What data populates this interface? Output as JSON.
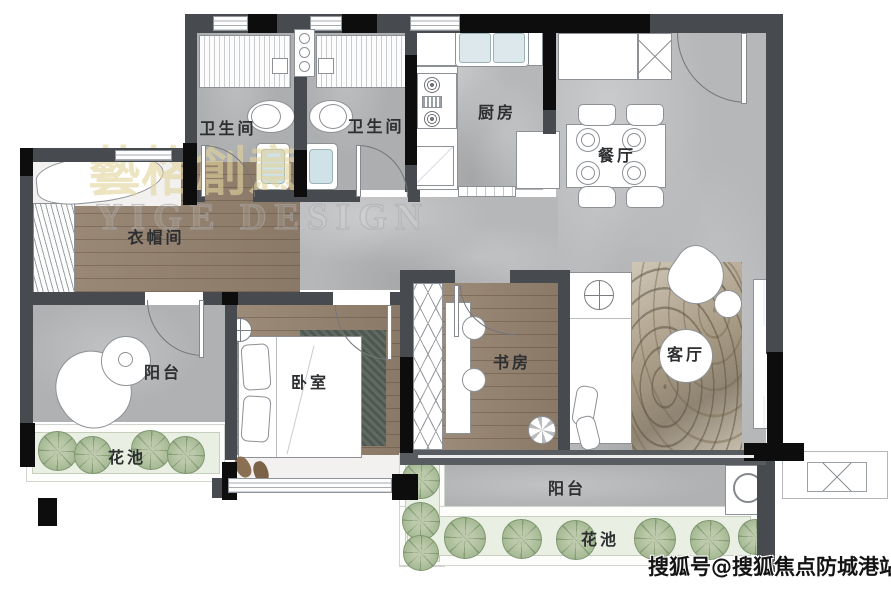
{
  "rooms": {
    "bathroom_left": {
      "label": "卫生间"
    },
    "bathroom_right": {
      "label": "卫生间"
    },
    "kitchen": {
      "label": "厨房"
    },
    "dining": {
      "label": "餐厅"
    },
    "cloakroom": {
      "label": "衣帽间"
    },
    "balcony_left": {
      "label": "阳台"
    },
    "flowerbed_left": {
      "label": "花池"
    },
    "bedroom": {
      "label": "卧室"
    },
    "study": {
      "label": "书房"
    },
    "living": {
      "label": "客厅"
    },
    "balcony_south": {
      "label": "阳台"
    },
    "flowerbed_south": {
      "label": "花池"
    }
  },
  "watermarks": {
    "studio_cn": "藝格創意",
    "studio_en": "YIGE DESIGN",
    "sohu": "搜狐号@搜狐焦点防城港站"
  },
  "palette": {
    "wall": "#474b50",
    "wall_black": "#0d0d0e",
    "marble_floor": "#b6b7b9",
    "wood_floor": "#95826f",
    "balcony_floor": "#b0b1b3",
    "flowerbed_green": "#e9efe2",
    "plant_green": "#9fb590",
    "watermark_gold": "#e3d6a2"
  }
}
